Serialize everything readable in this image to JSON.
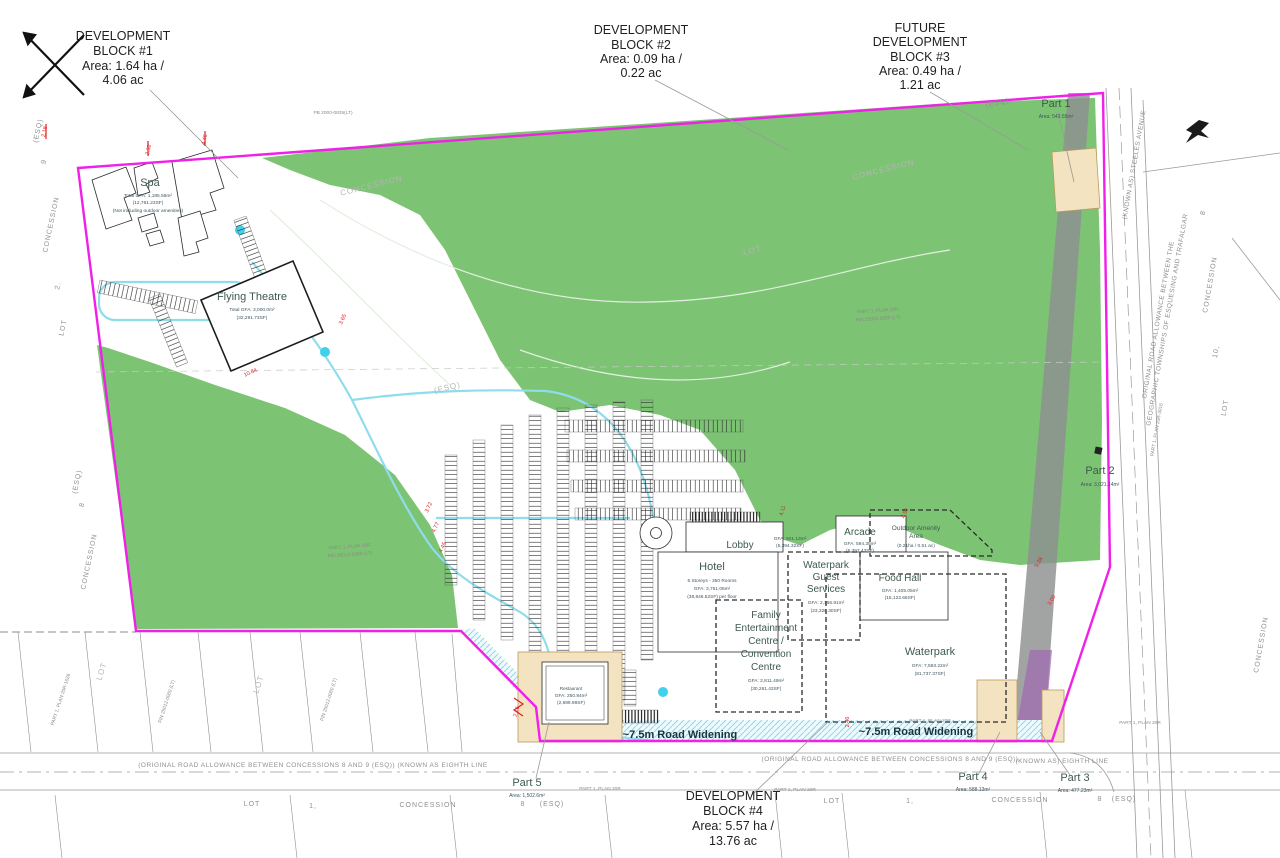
{
  "blocks": {
    "b1": {
      "l1": "DEVELOPMENT",
      "l2": "BLOCK #1",
      "l3": "Area: 1.64 ha /",
      "l4": "4.06 ac"
    },
    "b2": {
      "l1": "DEVELOPMENT",
      "l2": "BLOCK #2",
      "l3": "Area: 0.09 ha /",
      "l4": "0.22 ac"
    },
    "b3": {
      "l1": "FUTURE",
      "l2": "DEVELOPMENT",
      "l3": "BLOCK #3",
      "l4": "Area: 0.49 ha /",
      "l5": "1.21 ac"
    },
    "b4": {
      "l1": "DEVELOPMENT",
      "l2": "BLOCK #4",
      "l3": "Area: 5.57 ha /",
      "l4": "13.76 ac"
    }
  },
  "parts": {
    "p1": {
      "name": "Part 1",
      "area": "Area: 543.55m²"
    },
    "p2": {
      "name": "Part 2",
      "area": "Area: 3,021.14m²"
    },
    "p3": {
      "name": "Part 3",
      "area": "Area: 477.23m²"
    },
    "p4": {
      "name": "Part 4",
      "area": "Area: 588.13m²"
    },
    "p5": {
      "name": "Part 5",
      "area": "Area: 1,502.6m²"
    }
  },
  "buildings": {
    "spa": {
      "name": "Spa",
      "gfa1": "Total GFA: 1,185.55m²",
      "gfa2": "(12,761.23SF)",
      "gfa3": "(Not including outdoor amenities)"
    },
    "flying_theatre": {
      "name": "Flying Theatre",
      "gfa1": "Total GFA: 3,000.0m²",
      "gfa2": "(32,291.73SF)"
    },
    "hotel": {
      "name": "Hotel",
      "line1": "6 Storeys - 350 Rooms",
      "line2": "GFA: 3,751.06m²",
      "line3": "(38,846.52SF) per floor"
    },
    "lobby": {
      "name": "Lobby",
      "gfa1": "GFA: 501.13m²",
      "gfa2": "(5,394.32SF)"
    },
    "wgs": {
      "name1": "Waterpark",
      "name2": "Guest",
      "name3": "Services",
      "gfa1": "GFA: 2,166.91m²",
      "gfa2": "(23,326.30SF)"
    },
    "arcade": {
      "name": "Arcade",
      "gfa1": "GFA: 594.35m²",
      "gfa2": "(6,397.43SF)"
    },
    "food_hall": {
      "name": "Food Hall",
      "gfa1": "GFA: 1,405.05m²",
      "gfa2": "(15,123.66SF)"
    },
    "fec": {
      "name1": "Family",
      "name2": "Entertainment",
      "name3": "Centre /",
      "name4": "Convention",
      "name5": "Centre",
      "gfa1": "GFA: 2,811.49m²",
      "gfa2": "(30,261.43SF)"
    },
    "waterpark": {
      "name": "Waterpark",
      "gfa1": "GFA: 7,593.22m²",
      "gfa2": "(81,737.37SF)"
    },
    "outdoor": {
      "name1": "Outdoor Amenity",
      "name2": "Area",
      "area": "(0.21ha / 0.51 ac)"
    },
    "restaurant": {
      "name": "Restaurant",
      "gfa1": "GFA: 250.84m²",
      "gfa2": "(2,699.98SF)"
    }
  },
  "roads": {
    "widening_left": "~7.5m Road Widening",
    "widening_right": "~7.5m Road Widening",
    "allowance_left": "(ORIGINAL ROAD ALLOWANCE BETWEEN CONCESSIONS 8 AND 9 (ESQ)) (KNOWN AS EIGHTH LINE",
    "allowance_right": "(ORIGINAL ROAD ALLOWANCE BETWEEN CONCESSIONS 8 AND 9 (ESQ))",
    "known_as_right": "(KNOWN AS) EIGHTH LINE",
    "steeles": "(KNOWN AS) STEELES AVENUE",
    "orig1": "ORIGINAL ROAD ALLOWANCE BETWEEN THE",
    "orig2": "GEOGRAPHIC TOWNSHIPS OF ESQUESING AND TRAFALGAR"
  },
  "survey": {
    "left": [
      {
        "t": "(ESQ)",
        "x": 40,
        "y": 131,
        "r": -78
      },
      {
        "t": "9",
        "x": 46,
        "y": 162,
        "r": -78
      },
      {
        "t": "CONCESSION",
        "x": 53,
        "y": 225,
        "r": -78
      },
      {
        "t": "2.",
        "x": 60,
        "y": 286,
        "r": -78
      },
      {
        "t": "LOT",
        "x": 65,
        "y": 328,
        "r": -78
      },
      {
        "t": "(ESQ)",
        "x": 79,
        "y": 482,
        "r": -78
      },
      {
        "t": "8",
        "x": 84,
        "y": 505,
        "r": -78
      },
      {
        "t": "CONCESSION",
        "x": 91,
        "y": 562,
        "r": -78
      }
    ],
    "right": [
      {
        "t": "(ESQ)",
        "x": 998,
        "y": 105,
        "r": -12
      },
      {
        "t": "8",
        "x": 1205,
        "y": 213,
        "r": -80
      },
      {
        "t": "CONCESSION",
        "x": 1212,
        "y": 285,
        "r": -80
      },
      {
        "t": "10,",
        "x": 1218,
        "y": 352,
        "r": -80
      },
      {
        "t": "LOT",
        "x": 1227,
        "y": 408,
        "r": -80
      },
      {
        "t": "CONCESSION",
        "x": 1263,
        "y": 645,
        "r": -80
      }
    ],
    "bottom": [
      {
        "t": "LOT",
        "x": 252,
        "y": 806,
        "r": 0
      },
      {
        "t": "1,",
        "x": 313,
        "y": 808,
        "r": 0
      },
      {
        "t": "CONCESSION",
        "x": 428,
        "y": 807,
        "r": 0
      },
      {
        "t": "8",
        "x": 523,
        "y": 806,
        "r": 0
      },
      {
        "t": "(ESQ)",
        "x": 552,
        "y": 806,
        "r": 0
      },
      {
        "t": "LOT",
        "x": 832,
        "y": 803,
        "r": 0
      },
      {
        "t": "1,",
        "x": 910,
        "y": 803,
        "r": 0
      },
      {
        "t": "CONCESSION",
        "x": 1020,
        "y": 802,
        "r": 0
      },
      {
        "t": "8",
        "x": 1100,
        "y": 801,
        "r": 0
      },
      {
        "t": "(ESQ)",
        "x": 1124,
        "y": 801,
        "r": 0
      }
    ],
    "watermarks": [
      {
        "t": "CONCESSION",
        "x": 372,
        "y": 188,
        "r": -14
      },
      {
        "t": "CONCESSION",
        "x": 884,
        "y": 172,
        "r": -14
      },
      {
        "t": "LOT",
        "x": 753,
        "y": 253,
        "r": -14
      },
      {
        "t": "(ESQ)",
        "x": 448,
        "y": 390,
        "r": -14
      },
      {
        "t": "LOT",
        "x": 104,
        "y": 672,
        "r": -72
      },
      {
        "t": "LOT",
        "x": 261,
        "y": 685,
        "r": -72
      }
    ],
    "tiny": [
      {
        "t": "PB 2000-0835(LT)",
        "x": 333,
        "y": 114,
        "r": 0
      },
      {
        "t": "PART 1, PLAN 20R",
        "x": 878,
        "y": 312,
        "r": -4
      },
      {
        "t": "PIN 25005-0060 (LT)",
        "x": 878,
        "y": 320,
        "r": -4
      },
      {
        "t": "PART 1, PLAN 20R",
        "x": 350,
        "y": 548,
        "r": -4
      },
      {
        "t": "PIN 25012-0060 (LT)",
        "x": 350,
        "y": 556,
        "r": -4
      },
      {
        "t": "PART 1, PLAN 20R",
        "x": 1140,
        "y": 724,
        "r": 0
      },
      {
        "t": "PART 1, PLAN 20R",
        "x": 600,
        "y": 790,
        "r": 0
      },
      {
        "t": "PART 1, PLAN 20R",
        "x": 795,
        "y": 791,
        "r": 0
      },
      {
        "t": "PART 1, PLAN 20R",
        "x": 930,
        "y": 722,
        "r": 0
      },
      {
        "t": "PART 1, PLAN 20R-3016",
        "x": 1158,
        "y": 430,
        "r": -80
      },
      {
        "t": "PART 1, PLAN 20R-1628",
        "x": 62,
        "y": 700,
        "r": -72
      },
      {
        "t": "PIN 25012-0060 (LT)",
        "x": 168,
        "y": 702,
        "r": -72
      },
      {
        "t": "PIN 25012-0060 (LT)",
        "x": 330,
        "y": 700,
        "r": -72
      }
    ],
    "red": [
      {
        "t": "2.18",
        "x": 46,
        "y": 132,
        "r": -78
      },
      {
        "t": "2.32",
        "x": 150,
        "y": 150,
        "r": -78
      },
      {
        "t": "4.46",
        "x": 206,
        "y": 140,
        "r": -78
      },
      {
        "t": "10.84",
        "x": 251,
        "y": 374,
        "r": -24
      },
      {
        "t": "3.65",
        "x": 344,
        "y": 320,
        "r": -65
      },
      {
        "t": "3.72",
        "x": 430,
        "y": 508,
        "r": -65
      },
      {
        "t": "4.77",
        "x": 437,
        "y": 528,
        "r": -65
      },
      {
        "t": "4.45",
        "x": 444,
        "y": 548,
        "r": -65
      },
      {
        "t": "2.16",
        "x": 518,
        "y": 712,
        "r": -75
      },
      {
        "t": "2.56",
        "x": 906,
        "y": 514,
        "r": -60
      },
      {
        "t": "4.11",
        "x": 784,
        "y": 511,
        "r": -75
      },
      {
        "t": "5.28",
        "x": 1040,
        "y": 563,
        "r": -60
      },
      {
        "t": "3.00",
        "x": 1053,
        "y": 601,
        "r": -60
      },
      {
        "t": "2.46",
        "x": 849,
        "y": 722,
        "r": -90
      }
    ]
  },
  "colors": {
    "parcel_boundary": "#F020E8",
    "vegetation": "#7CC473",
    "drive_aisle": "#8FDCEC",
    "beige_parcel": "#F3E3C0",
    "hydro_corridor": "#8E9090",
    "easement": "#A06CB0",
    "dimension_text": "#E02020"
  }
}
